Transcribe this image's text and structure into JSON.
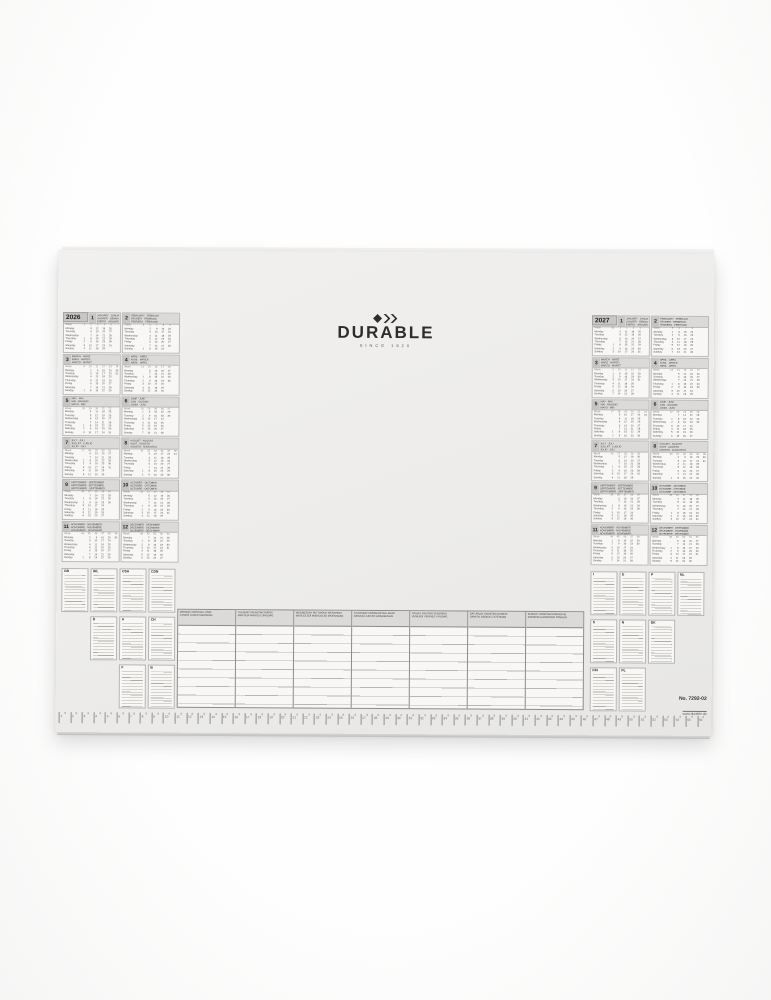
{
  "brand": {
    "logo_text": "DURABLE",
    "tagline": "SINCE 1920",
    "logo_color": "#2d2d2d"
  },
  "footer": {
    "item_no": "No. 7292-02",
    "website": "www.durable.de"
  },
  "pad_colors": {
    "sheet": "#edecea",
    "grid_line": "#8c8b89",
    "header_fill": "#dbdad8"
  },
  "calendar_common": {
    "week_label": "Week",
    "weekdays": [
      "Monday",
      "Tuesday",
      "Wednesday",
      "Thursday",
      "Friday",
      "Saturday",
      "Sunday"
    ]
  },
  "years": [
    {
      "year": "2026",
      "months": [
        {
          "num": 1,
          "names": [
            "JANUARY · JANUAR",
            "JANVIER · GENNAIO",
            "ENERO · JANUARI"
          ],
          "start": 3,
          "days": 31,
          "first_week": 1
        },
        {
          "num": 2,
          "names": [
            "FEBRUARY · FEBRUAR",
            "FÉVRIER · FEBBRAIO",
            "FEBRERO · FEBRUARI"
          ],
          "start": 6,
          "days": 28,
          "first_week": 5
        },
        {
          "num": 3,
          "names": [
            "MARCH · MÄRZ",
            "MARS · MARZO",
            "MARZO · MAART"
          ],
          "start": 6,
          "days": 31,
          "first_week": 9
        },
        {
          "num": 4,
          "names": [
            "APRIL · APRIL",
            "AVRIL · APRILE",
            "ABRIL · APRIL"
          ],
          "start": 2,
          "days": 30,
          "first_week": 14
        },
        {
          "num": 5,
          "names": [
            "MAY · MAI",
            "MAI · MAGGIO",
            "MAYO · MEI"
          ],
          "start": 4,
          "days": 31,
          "first_week": 18
        },
        {
          "num": 6,
          "names": [
            "JUNE · JUNI",
            "JUIN · GIUGNO",
            "JUNIO · JUNI"
          ],
          "start": 0,
          "days": 30,
          "first_week": 23
        },
        {
          "num": 7,
          "names": [
            "JULY · JULI",
            "JUILLET · LUGLIO",
            "JULIO · JULI"
          ],
          "start": 2,
          "days": 31,
          "first_week": 27
        },
        {
          "num": 8,
          "names": [
            "AUGUST · AUGUST",
            "AOÛT · AGOSTO",
            "AGOSTO · AUGUSTUS"
          ],
          "start": 5,
          "days": 31,
          "first_week": 31
        },
        {
          "num": 9,
          "names": [
            "SEPTEMBER · SEPTEMBER",
            "SEPTEMBRE · SETTEMBRE",
            "SEPTIEMBRE · SEPTEMBER"
          ],
          "start": 1,
          "days": 30,
          "first_week": 36
        },
        {
          "num": 10,
          "names": [
            "OCTOBER · OKTOBER",
            "OCTOBRE · OTTOBRE",
            "OCTUBRE · OKTOBER"
          ],
          "start": 3,
          "days": 31,
          "first_week": 40
        },
        {
          "num": 11,
          "names": [
            "NOVEMBER · NOVEMBER",
            "NOVEMBRE · NOVEMBRE",
            "NOVIEMBRE · NOVEMBER"
          ],
          "start": 6,
          "days": 30,
          "first_week": 44
        },
        {
          "num": 12,
          "names": [
            "DECEMBER · DEZEMBER",
            "DÉCEMBRE · DICEMBRE",
            "DICIEMBRE · DECEMBER"
          ],
          "start": 1,
          "days": 31,
          "first_week": 49
        }
      ]
    },
    {
      "year": "2027",
      "months": [
        {
          "num": 1,
          "names": [
            "JANUARY · JANUAR",
            "JANVIER · GENNAIO",
            "ENERO · JANUARI"
          ],
          "start": 4,
          "days": 31,
          "first_week": 53
        },
        {
          "num": 2,
          "names": [
            "FEBRUARY · FEBRUAR",
            "FÉVRIER · FEBBRAIO",
            "FEBRERO · FEBRUARI"
          ],
          "start": 0,
          "days": 28,
          "first_week": 5
        },
        {
          "num": 3,
          "names": [
            "MARCH · MÄRZ",
            "MARS · MARZO",
            "MARZO · MAART"
          ],
          "start": 0,
          "days": 31,
          "first_week": 9
        },
        {
          "num": 4,
          "names": [
            "APRIL · APRIL",
            "AVRIL · APRILE",
            "ABRIL · APRIL"
          ],
          "start": 3,
          "days": 30,
          "first_week": 13
        },
        {
          "num": 5,
          "names": [
            "MAY · MAI",
            "MAI · MAGGIO",
            "MAYO · MEI"
          ],
          "start": 5,
          "days": 31,
          "first_week": 17
        },
        {
          "num": 6,
          "names": [
            "JUNE · JUNI",
            "JUIN · GIUGNO",
            "JUNIO · JUNI"
          ],
          "start": 1,
          "days": 30,
          "first_week": 22
        },
        {
          "num": 7,
          "names": [
            "JULY · JULI",
            "JUILLET · LUGLIO",
            "JULIO · JULI"
          ],
          "start": 3,
          "days": 31,
          "first_week": 26
        },
        {
          "num": 8,
          "names": [
            "AUGUST · AUGUST",
            "AOÛT · AGOSTO",
            "AGOSTO · AUGUSTUS"
          ],
          "start": 6,
          "days": 31,
          "first_week": 30
        },
        {
          "num": 9,
          "names": [
            "SEPTEMBER · SEPTEMBER",
            "SEPTEMBRE · SETTEMBRE",
            "SEPTIEMBRE · SEPTEMBER"
          ],
          "start": 2,
          "days": 30,
          "first_week": 35
        },
        {
          "num": 10,
          "names": [
            "OCTOBER · OKTOBER",
            "OCTOBRE · OTTOBRE",
            "OCTUBRE · OKTOBER"
          ],
          "start": 4,
          "days": 31,
          "first_week": 39
        },
        {
          "num": 11,
          "names": [
            "NOVEMBER · NOVEMBER",
            "NOVEMBRE · NOVEMBRE",
            "NOVIEMBRE · NOVEMBER"
          ],
          "start": 0,
          "days": 30,
          "first_week": 44
        },
        {
          "num": 12,
          "names": [
            "DECEMBER · DEZEMBER",
            "DÉCEMBRE · DICEMBRE",
            "DICIEMBRE · DECEMBER"
          ],
          "start": 2,
          "days": 31,
          "first_week": 48
        }
      ]
    }
  ],
  "planner": {
    "rows": 10,
    "day_headers": [
      {
        "line1": "MONDAY MONTAG LUNDI",
        "line2": "LUNEDÌ LUNES MAANDAG"
      },
      {
        "line1": "TUESDAY DIENSTAG MARDI",
        "line2": "MARTEDÌ MARTES DINSDAG"
      },
      {
        "line1": "WEDNESDAY MITTWOCH MERCREDI",
        "line2": "MERCOLEDÌ MIÉRCOLES WOENSDAG"
      },
      {
        "line1": "THURSDAY DONNERSTAG JEUDI",
        "line2": "GIOVEDÌ JUEVES DONDERDAG"
      },
      {
        "line1": "FRIDAY FREITAG VENDREDI",
        "line2": "VENERDÌ VIERNES VRIJDAG"
      },
      {
        "line1": "SATURDAY SAMSTAG SAMEDI",
        "line2": "SABATO SÁBADO ZATERDAG"
      },
      {
        "line1": "SUNDAY SONNTAG DIMANCHE",
        "line2": "DOMENICA DOMINGO ZONDAG"
      }
    ]
  },
  "legend": {
    "left": [
      [
        "GB",
        "IRL",
        "USA",
        "CDN"
      ],
      [
        "D",
        "A",
        "CH"
      ],
      [
        "F",
        "B"
      ]
    ],
    "right": [
      [
        "I",
        "E",
        "P",
        "NL"
      ],
      [
        "S",
        "N",
        "DK"
      ],
      [
        "FIN",
        "PL"
      ]
    ]
  },
  "ruler": {
    "unit": "cm",
    "from": 1,
    "to": 56
  }
}
